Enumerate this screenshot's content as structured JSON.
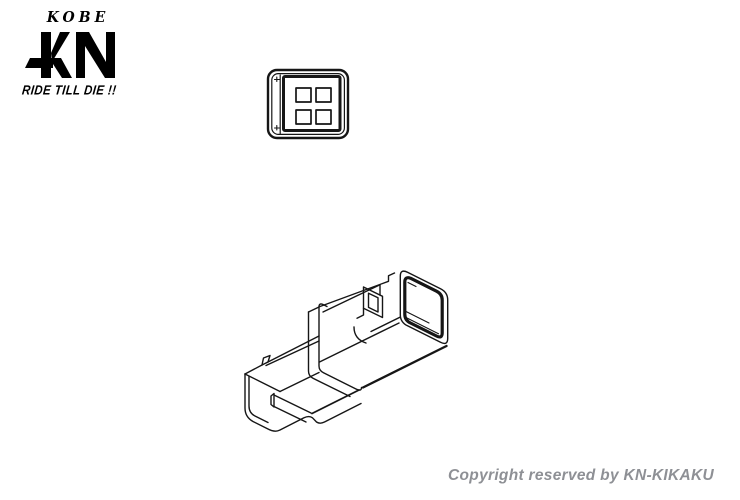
{
  "page": {
    "background": "#ffffff",
    "line_color": "#161616"
  },
  "logo": {
    "kobe": "KOBE",
    "monogram": "KN",
    "tagline": "RIDE TILL DIE !!",
    "color": "#000000"
  },
  "figures": {
    "front_view": {
      "label": "connector front view",
      "pin_holes": 4,
      "rows": 2,
      "cols": 2
    },
    "isometric_view": {
      "label": "connector housing isometric line drawing"
    }
  },
  "footer": {
    "copyright": "Copyright reserved by KN-KIKAKU",
    "color": "#8e9095"
  }
}
